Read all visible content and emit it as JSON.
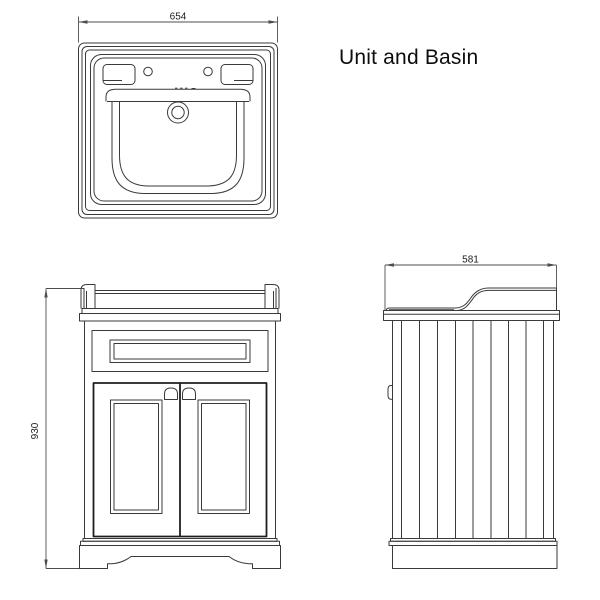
{
  "title": "Unit and Basin",
  "views": {
    "plan": {
      "name": "basin plan view",
      "width_label": "654"
    },
    "front": {
      "name": "front elevation",
      "height_label": "930"
    },
    "side": {
      "name": "side elevation",
      "depth_label": "581"
    }
  },
  "colors": {
    "background": "#ffffff",
    "line_work": "#3a3a3a",
    "dimension_lines": "#4d4d4d",
    "text": "#111111"
  }
}
